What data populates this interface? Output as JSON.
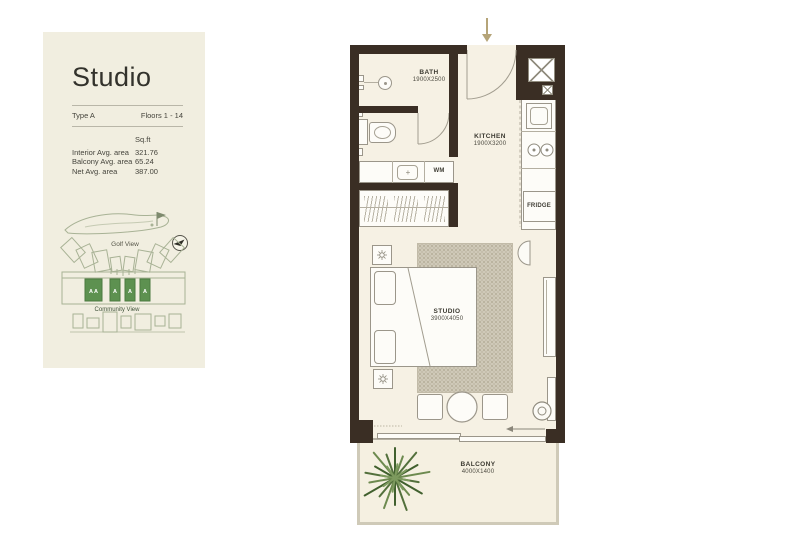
{
  "info_panel": {
    "title": "Studio",
    "type": "Type A",
    "floors": "Floors 1 - 14",
    "area_unit_header": "Sq.ft",
    "area_rows": [
      {
        "label": "Interior Avg. area",
        "value": "321.76"
      },
      {
        "label": "Balcony Avg. area",
        "value": "65.24"
      },
      {
        "label": "Net Avg. area",
        "value": "387.00"
      }
    ],
    "site_map": {
      "golf_view_label": "Golf View",
      "community_view_label": "Community View",
      "highlighted_units": [
        "A A",
        "A",
        "A",
        "A"
      ]
    }
  },
  "floor_plan": {
    "rooms": {
      "bath": {
        "name": "BATH",
        "dimensions": "1900X2500"
      },
      "kitchen": {
        "name": "KITCHEN",
        "dimensions": "1900X3200"
      },
      "studio": {
        "name": "STUDIO",
        "dimensions": "3900X4050"
      },
      "balcony": {
        "name": "BALCONY",
        "dimensions": "4000X1400"
      }
    },
    "appliance_labels": {
      "washing_machine": "WM",
      "fridge": "FRIDGE"
    }
  },
  "colors": {
    "panel_background": "#f1eee0",
    "wall": "#3a2e24",
    "floor": "#f6f1e4",
    "rug": "#cfc9b8",
    "unit_highlight_green": "#5d9150",
    "entry_arrow_tan": "#b5a478"
  }
}
